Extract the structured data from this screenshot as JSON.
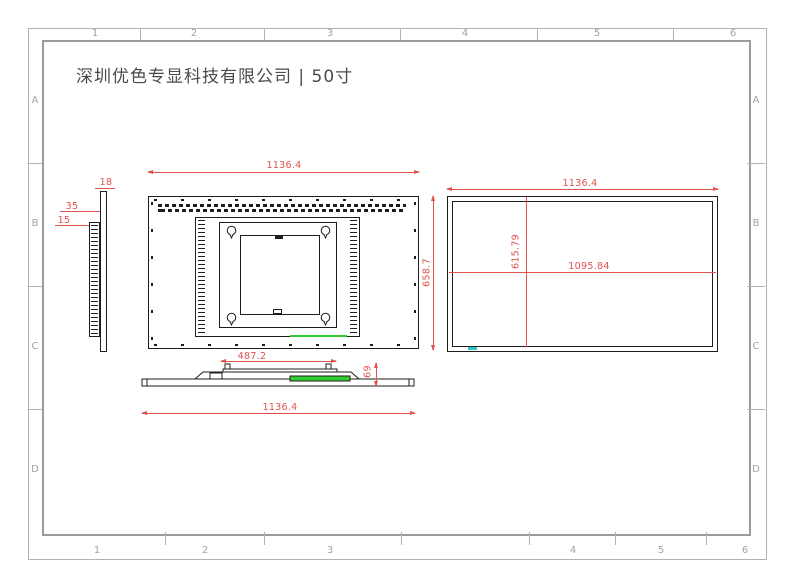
{
  "title": "深圳优色专显科技有限公司 | 50寸",
  "frame": {
    "columns": [
      "1",
      "2",
      "3",
      "4",
      "5",
      "6"
    ],
    "rows": [
      "A",
      "B",
      "C",
      "D"
    ]
  },
  "dimensions": {
    "rear_width": "1136.4",
    "overall_height": "658.7",
    "vesa_width": "487.2",
    "panel_thickness": "18",
    "depth_total": "35",
    "depth_front": "15",
    "profile_height": "69",
    "bottom_width": "1136.4",
    "front_width": "1136.4",
    "active_width": "1095.84",
    "active_height": "615.79"
  },
  "colors": {
    "ink": "#1d1d1b",
    "dim-red": "#e0524c",
    "vent-green": "#2ecc2e",
    "touch-cyan": "#35c4c4",
    "frame-gray": "#b2b2b2",
    "frame-border": "#9c9c9c",
    "label-gray": "#a2a2a2",
    "title-gray": "#4a4a4a"
  }
}
